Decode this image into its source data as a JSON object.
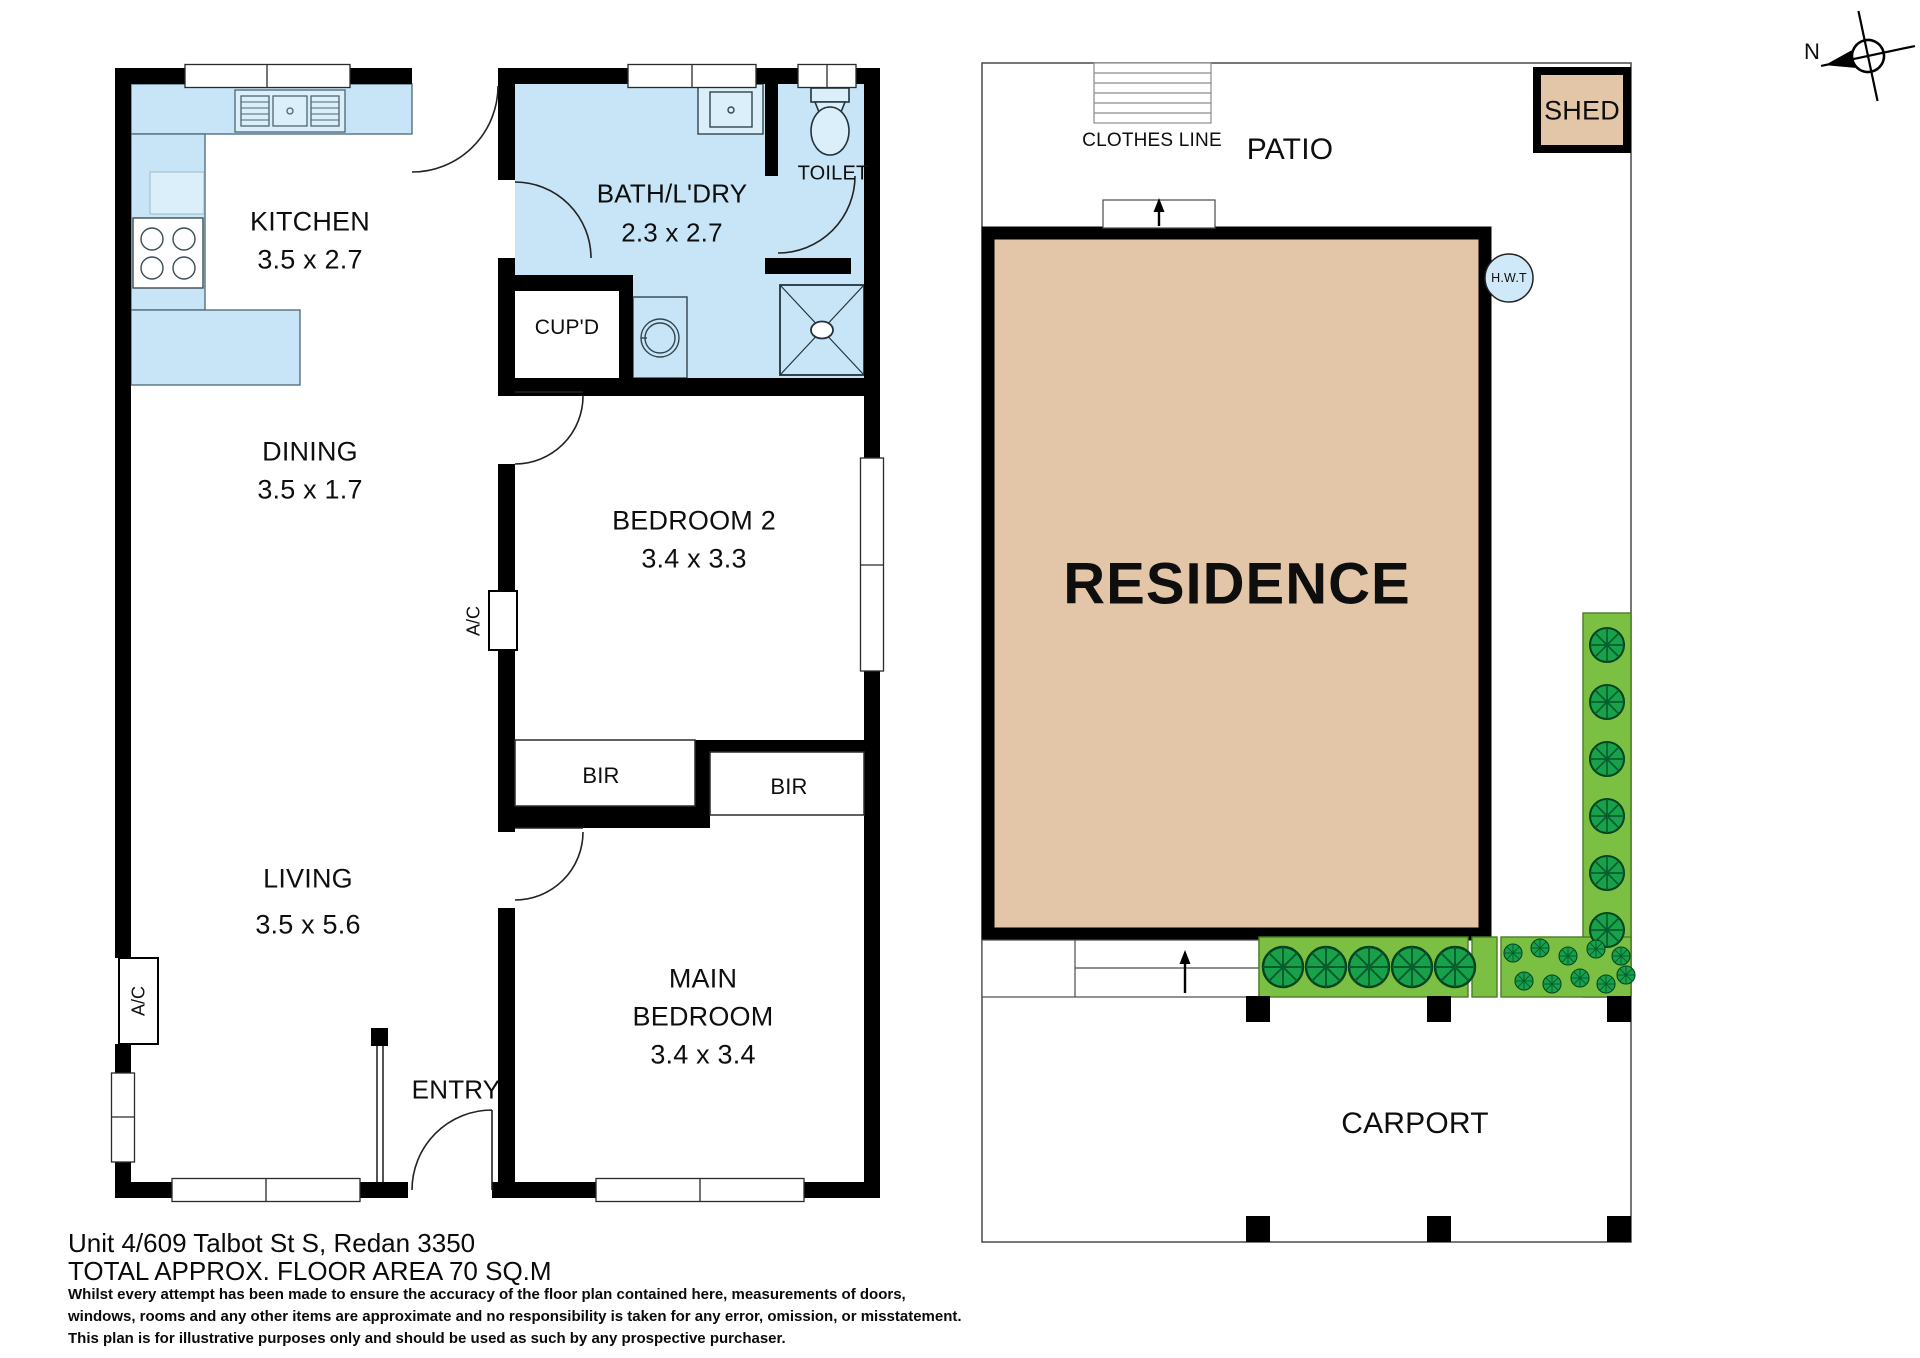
{
  "floorplan": {
    "rooms": {
      "kitchen": {
        "name": "KITCHEN",
        "dims": "3.5 x 2.7"
      },
      "bath": {
        "name": "BATH/L'DRY",
        "dims": "2.3 x 2.7"
      },
      "toilet": {
        "name": "TOILET"
      },
      "cupboard": {
        "name": "CUP'D"
      },
      "dining": {
        "name": "DINING",
        "dims": "3.5 x 1.7"
      },
      "bedroom2": {
        "name": "BEDROOM 2",
        "dims": "3.4 x 3.3"
      },
      "living": {
        "name": "LIVING",
        "dims": "3.5 x 5.6"
      },
      "main_bedroom": {
        "line1": "MAIN",
        "line2": "BEDROOM",
        "dims": "3.4 x 3.4"
      },
      "entry": {
        "name": "ENTRY"
      },
      "bir_left": "BIR",
      "bir_right": "BIR",
      "ac": "A/C"
    }
  },
  "site": {
    "clothes_line": "CLOTHES LINE",
    "patio": "PATIO",
    "shed": "SHED",
    "residence": "RESIDENCE",
    "hwt": "H.W.T",
    "carport": "CARPORT",
    "compass_north": "N"
  },
  "footer": {
    "address": "Unit 4/609 Talbot St S, Redan 3350",
    "area": "TOTAL APPROX. FLOOR AREA 70 SQ.M",
    "disclaimer": [
      "Whilst every attempt has been made to ensure the accuracy of the floor plan contained here, measurements of doors,",
      "windows, rooms and any other items are approximate and no responsibility is taken for any error, omission, or misstatement.",
      "This plan is for illustrative purposes only and should be used as such by any prospective purchaser."
    ]
  },
  "colors": {
    "wet_area": "#c7e5f7",
    "fixture": "#dbeffb",
    "building": "#e3c5a7",
    "garden": "#7cc043",
    "bush": "#18a14b",
    "wall": "#000000"
  }
}
